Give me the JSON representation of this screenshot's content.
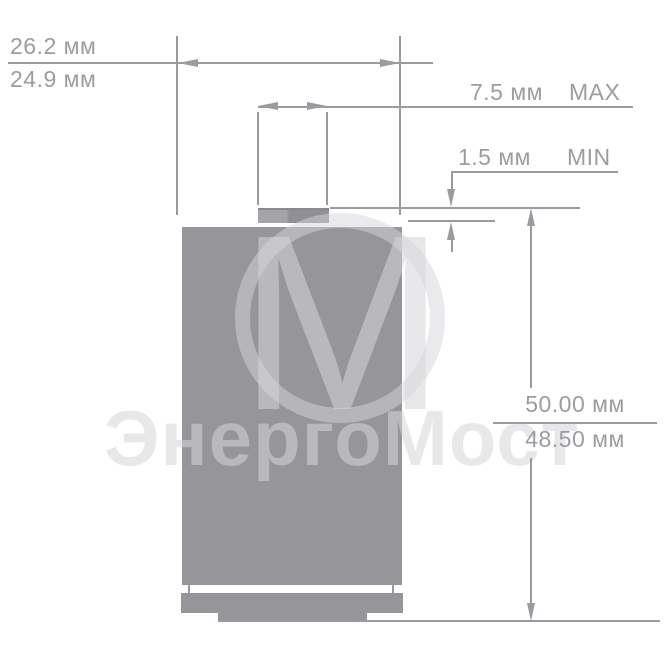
{
  "watermark": {
    "monogram_letter": "М",
    "brand_text": "ЭнергоМост"
  },
  "dimensions": {
    "width_max": "26.2 мм",
    "width_min": "24.9 мм",
    "cap_diameter_value": "7.5 мм",
    "cap_diameter_qualifier": "MAX",
    "cap_height_value": "1.5 мм",
    "cap_height_qualifier": "MIN",
    "height_max": "50.00 мм",
    "height_min": "48.50 мм"
  },
  "colors": {
    "battery_body": "#95959a",
    "cap_light": "#a4a4a9",
    "cap_dark": "#8f8f95",
    "dimension_line": "#9a9aa0",
    "label_text": "#9c9ca1",
    "watermark": "#d5d5da",
    "background": "#ffffff"
  }
}
